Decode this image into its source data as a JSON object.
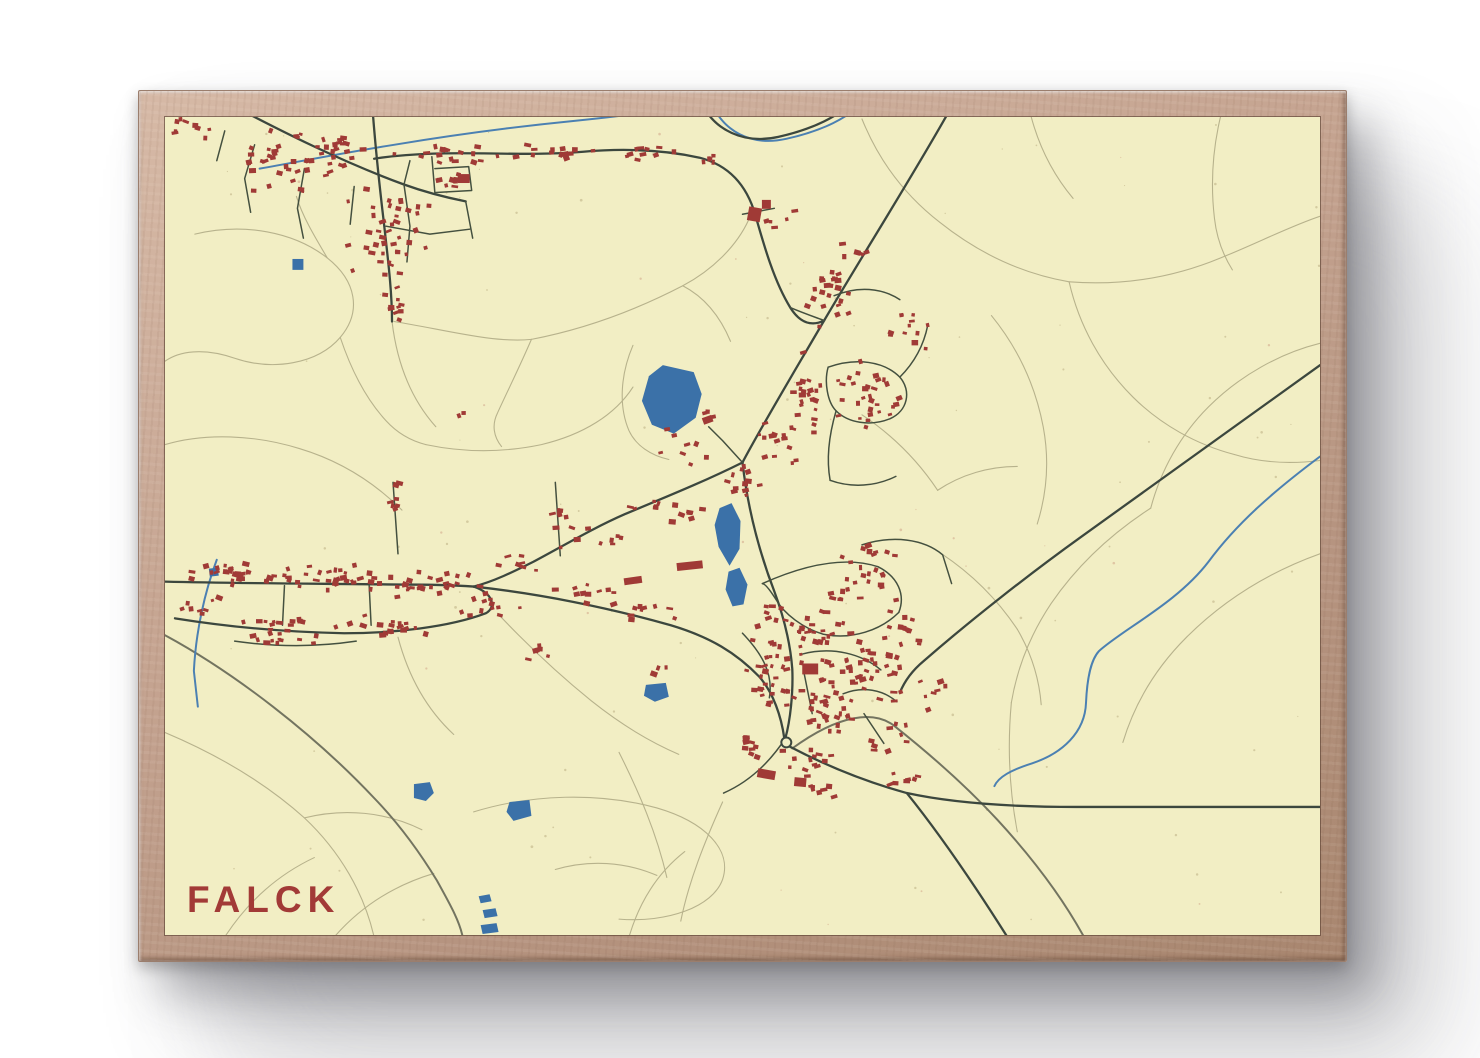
{
  "poster": {
    "title": "FALCK",
    "title_color": "#a23a37"
  },
  "frame": {
    "wood_light": "#d6b9a6",
    "wood_dark": "#a8866f"
  },
  "map": {
    "background": "#f2eec4",
    "seed": 20,
    "speckle_count": 120,
    "colors": {
      "building": "#a03a36",
      "water": "#3b71a8",
      "stream": "#4b80b2",
      "road_major": "#3c473e",
      "road_minor": "#44503f",
      "road_secondary": "#737460",
      "trail": "#b7b28c"
    },
    "roundabout": {
      "x": 624,
      "y": 630
    },
    "streams": [
      {
        "d": "M 95,52 C 140,44 180,36 230,28 C 290,18 350,10 410,4 C 450,0 505,-6 548,-16"
      },
      {
        "d": "M 548,-16 C 560,14 588,30 624,22 C 660,14 688,0 698,-14"
      },
      {
        "d": "M 52,446 C 40,478 31,518 29,558 L 33,594"
      },
      {
        "d": "M 1160,342 C 1112,378 1076,410 1048,448 C 1016,490 962,516 938,538 C 929,548 926,568 925,590 C 924,620 901,641 871,651 C 849,658 837,665 833,674"
      }
    ],
    "waters": [
      {
        "points": "500,250 531,257 539,279 533,303 511,319 489,310 479,286 486,261"
      },
      {
        "points": "557,394 569,389 578,407 577,435 567,452 556,433 552,411"
      },
      {
        "points": "566,458 577,454 585,471 581,491 570,493 563,476"
      },
      {
        "points": "250,672 266,670 270,681 262,689 250,686"
      },
      {
        "points": "346,690 366,688 368,704 350,709 343,700"
      },
      {
        "points": "483,572 503,570 506,584 492,589 481,583"
      },
      {
        "points": "128,143 139,143 139,154 128,154"
      },
      {
        "points": "315,785 326,783 328,790 317,792"
      },
      {
        "points": "319,799 332,797 334,805 321,807"
      },
      {
        "points": "317,814 333,812 335,821 319,823"
      },
      {
        "points": "44,455 53,454 54,462 45,463"
      }
    ],
    "roads_major": [
      {
        "d": "M 792,-14 C 758,48 700,140 662,205 C 630,260 600,310 580,348"
      },
      {
        "d": "M 580,348 C 585,392 596,436 612,478 C 622,505 628,530 630,556 C 631,580 628,608 623,626"
      },
      {
        "d": "M 580,348 C 540,368 500,384 462,400 C 430,414 400,432 370,448 C 350,458 330,468 310,473"
      },
      {
        "d": "M 0,468 C 80,470 160,470 240,471 C 268,471 295,472 310,473"
      },
      {
        "d": "M 310,473 C 375,480 445,494 508,512 C 548,524 574,540 597,564 C 611,580 619,604 622,626"
      },
      {
        "d": "M 10,505 C 60,513 120,519 180,520 C 230,520 285,514 322,500 C 333,494 330,480 310,473"
      },
      {
        "d": "M 627,634 C 665,654 705,670 745,681 C 795,692 855,695 915,695 L 1160,695"
      },
      {
        "d": "M 745,681 C 778,722 812,772 846,826"
      },
      {
        "d": "M 1160,250 C 1080,308 1000,366 920,423 C 870,459 810,506 762,548 C 750,558 742,570 738,580"
      },
      {
        "d": "M 67,-12 C 120,16 180,46 240,68 C 262,76 282,81 302,85"
      },
      {
        "d": "M 210,42 C 280,31 350,41 420,35 C 465,31 505,34 537,41 C 568,49 585,71 593,99 C 602,131 612,166 628,192 C 638,208 650,211 662,205"
      },
      {
        "d": "M 540,-12 C 552,12 580,28 616,20 C 652,12 678,-2 688,-14"
      },
      {
        "d": "M 208,-14 C 211,28 215,66 220,108 C 224,144 228,176 228,206"
      }
    ],
    "roads_minor": [
      {
        "d": "M 90,28 L 80,62 L 86,96"
      },
      {
        "d": "M 140,52 L 133,92 L 139,122"
      },
      {
        "d": "M 190,70 L 186,108"
      },
      {
        "d": "M 240,68 L 246,110 L 243,146"
      },
      {
        "d": "M 240,68 L 246,44"
      },
      {
        "d": "M 222,110 L 266,118 L 306,113"
      },
      {
        "d": "M 268,40 L 271,76"
      },
      {
        "d": "M 271,52 L 305,50 L 308,74 L 272,76"
      },
      {
        "d": "M 60,14 L 52,44"
      },
      {
        "d": "M 302,85 L 309,122"
      },
      {
        "d": "M 580,98 L 612,92"
      },
      {
        "d": "M 666,252 C 694,242 722,246 738,262 C 750,276 746,296 728,304 C 708,312 686,308 674,296 C 665,287 662,266 666,252"
      },
      {
        "d": "M 738,262 C 752,248 762,230 766,210"
      },
      {
        "d": "M 674,296 C 667,320 664,344 668,366"
      },
      {
        "d": "M 668,366 C 690,374 714,372 734,362"
      },
      {
        "d": "M 672,180 C 696,170 720,172 738,184"
      },
      {
        "d": "M 628,192 C 642,198 654,202 662,205"
      },
      {
        "d": "M 600,470 C 640,452 682,442 716,453"
      },
      {
        "d": "M 716,453 C 736,463 744,481 737,499"
      },
      {
        "d": "M 737,499 C 719,517 690,527 661,521"
      },
      {
        "d": "M 661,521 C 641,515 622,501 613,485 C 606,474 602,470 600,470"
      },
      {
        "d": "M 640,541 C 671,533 700,541 719,557"
      },
      {
        "d": "M 580,520 C 600,541 611,561 607,585"
      },
      {
        "d": "M 642,561 L 650,601"
      },
      {
        "d": "M 681,581 C 701,573 721,577 735,589"
      },
      {
        "d": "M 702,601 L 722,631"
      },
      {
        "d": "M 700,431 C 731,421 762,425 781,441 L 790,470"
      },
      {
        "d": "M 623,626 C 606,652 586,670 561,681"
      },
      {
        "d": "M 229,368 L 234,440"
      },
      {
        "d": "M 392,368 L 397,442"
      },
      {
        "d": "M 120,472 L 118,512"
      },
      {
        "d": "M 205,471 L 207,512"
      },
      {
        "d": "M 70,528 C 112,534 152,534 192,528"
      },
      {
        "d": "M 580,348 L 560,326 L 546,312"
      }
    ],
    "roads_secondary": [
      {
        "d": "M 0,522 C 70,560 150,622 210,686 C 236,713 256,741 273,769 C 288,796 296,811 299,826"
      },
      {
        "d": "M 630,636 C 678,601 712,598 732,613 C 766,640 801,670 836,708 C 871,746 901,786 923,826"
      }
    ],
    "trails": [
      {
        "d": "M 30,118 C 80,106 130,116 163,142 C 192,165 198,196 176,222 C 153,249 108,256 70,243 C 38,232 14,236 0,246"
      },
      {
        "d": "M 163,142 C 150,120 138,100 132,80"
      },
      {
        "d": "M 0,330 C 40,318 90,320 135,334 C 175,346 210,368 238,396"
      },
      {
        "d": "M 176,222 C 186,252 200,282 222,306 C 232,317 246,326 262,330"
      },
      {
        "d": "M 262,330 C 300,338 340,338 378,330 C 420,320 452,300 470,272"
      },
      {
        "d": "M 470,230 C 458,258 455,290 466,316 C 473,331 488,341 506,345"
      },
      {
        "d": "M 228,206 C 233,248 247,284 272,312"
      },
      {
        "d": "M 230,206 C 280,214 330,228 368,224"
      },
      {
        "d": "M 368,224 C 420,214 470,196 520,170 C 550,154 574,130 586,104"
      },
      {
        "d": "M 520,170 C 543,182 558,202 568,226"
      },
      {
        "d": "M 368,224 C 356,252 344,276 334,298 C 328,310 330,322 338,332"
      },
      {
        "d": "M 700,2 C 716,42 742,78 778,106 C 818,138 862,158 908,166"
      },
      {
        "d": "M 908,166 C 960,170 1012,162 1060,142 C 1095,128 1130,110 1160,100"
      },
      {
        "d": "M 908,166 C 918,210 940,250 972,282 C 1000,310 1036,330 1074,340"
      },
      {
        "d": "M 1160,228 C 1120,238 1080,260 1048,292 C 1020,320 1000,356 990,394"
      },
      {
        "d": "M 870,0 C 878,30 892,58 912,82"
      },
      {
        "d": "M 1060,0 C 1052,34 1050,68 1054,102 C 1056,120 1062,138 1072,154"
      },
      {
        "d": "M 830,200 C 856,232 874,270 882,312 C 888,344 886,378 876,410"
      },
      {
        "d": "M 990,394 C 950,420 916,452 890,490 C 870,520 856,554 850,590"
      },
      {
        "d": "M 1160,440 C 1110,458 1064,486 1026,524 C 996,554 974,590 962,630"
      },
      {
        "d": "M 850,590 C 846,634 848,678 856,720"
      },
      {
        "d": "M 1074,340 C 1100,348 1128,350 1160,346"
      },
      {
        "d": "M 0,620 C 52,642 100,670 140,706 C 176,740 200,782 210,826"
      },
      {
        "d": "M 140,706 C 180,696 222,700 258,718"
      },
      {
        "d": "M 60,826 C 82,792 112,764 150,746"
      },
      {
        "d": "M 170,826 C 196,796 230,774 270,762"
      },
      {
        "d": "M 466,826 C 476,792 494,762 522,740"
      },
      {
        "d": "M 310,700 C 368,682 436,680 494,696 C 542,710 570,738 560,768 C 550,796 504,812 456,808"
      },
      {
        "d": "M 456,640 C 476,680 494,722 504,766"
      },
      {
        "d": "M 560,690 C 542,730 526,770 518,810"
      },
      {
        "d": "M 334,500 C 364,532 396,562 428,588 C 458,612 488,630 516,642"
      },
      {
        "d": "M 234,524 C 244,562 262,596 290,622"
      },
      {
        "d": "M 392,758 C 426,748 462,750 494,764"
      },
      {
        "d": "M 700,300 C 730,320 756,346 776,376"
      },
      {
        "d": "M 776,376 C 800,360 828,352 856,352"
      },
      {
        "d": "M 780,440 C 810,460 836,486 856,516"
      },
      {
        "d": "M 856,516 C 870,540 878,566 880,592"
      }
    ],
    "building_clusters": [
      {
        "x": 30,
        "y": 10,
        "rx": 30,
        "ry": 14,
        "n": 10
      },
      {
        "x": 150,
        "y": 42,
        "rx": 95,
        "ry": 38,
        "n": 55
      },
      {
        "x": 225,
        "y": 120,
        "rx": 45,
        "ry": 55,
        "n": 40
      },
      {
        "x": 232,
        "y": 185,
        "rx": 18,
        "ry": 28,
        "n": 10
      },
      {
        "x": 300,
        "y": 38,
        "rx": 60,
        "ry": 12,
        "n": 18
      },
      {
        "x": 390,
        "y": 34,
        "rx": 50,
        "ry": 10,
        "n": 12
      },
      {
        "x": 470,
        "y": 36,
        "rx": 45,
        "ry": 10,
        "n": 10
      },
      {
        "x": 545,
        "y": 45,
        "rx": 20,
        "ry": 10,
        "n": 6
      },
      {
        "x": 288,
        "y": 62,
        "rx": 16,
        "ry": 12,
        "n": 8
      },
      {
        "x": 668,
        "y": 175,
        "rx": 30,
        "ry": 50,
        "n": 24
      },
      {
        "x": 705,
        "y": 280,
        "rx": 45,
        "ry": 42,
        "n": 30
      },
      {
        "x": 745,
        "y": 215,
        "rx": 28,
        "ry": 30,
        "n": 12
      },
      {
        "x": 640,
        "y": 280,
        "rx": 28,
        "ry": 45,
        "n": 22
      },
      {
        "x": 612,
        "y": 330,
        "rx": 26,
        "ry": 30,
        "n": 14
      },
      {
        "x": 585,
        "y": 368,
        "rx": 24,
        "ry": 22,
        "n": 12
      },
      {
        "x": 520,
        "y": 330,
        "rx": 28,
        "ry": 22,
        "n": 9
      },
      {
        "x": 500,
        "y": 395,
        "rx": 60,
        "ry": 16,
        "n": 13
      },
      {
        "x": 430,
        "y": 425,
        "rx": 45,
        "ry": 14,
        "n": 9
      },
      {
        "x": 360,
        "y": 450,
        "rx": 35,
        "ry": 12,
        "n": 7
      },
      {
        "x": 70,
        "y": 460,
        "rx": 65,
        "ry": 15,
        "n": 26
      },
      {
        "x": 170,
        "y": 464,
        "rx": 70,
        "ry": 16,
        "n": 30
      },
      {
        "x": 265,
        "y": 470,
        "rx": 60,
        "ry": 16,
        "n": 26
      },
      {
        "x": 130,
        "y": 510,
        "rx": 70,
        "ry": 12,
        "n": 18
      },
      {
        "x": 230,
        "y": 512,
        "rx": 55,
        "ry": 12,
        "n": 15
      },
      {
        "x": 120,
        "y": 526,
        "rx": 45,
        "ry": 7,
        "n": 10
      },
      {
        "x": 330,
        "y": 490,
        "rx": 40,
        "ry": 14,
        "n": 12
      },
      {
        "x": 40,
        "y": 494,
        "rx": 28,
        "ry": 10,
        "n": 8
      },
      {
        "x": 230,
        "y": 392,
        "rx": 16,
        "ry": 26,
        "n": 8
      },
      {
        "x": 394,
        "y": 402,
        "rx": 14,
        "ry": 24,
        "n": 6
      },
      {
        "x": 430,
        "y": 480,
        "rx": 45,
        "ry": 12,
        "n": 11
      },
      {
        "x": 495,
        "y": 498,
        "rx": 40,
        "ry": 12,
        "n": 9
      },
      {
        "x": 370,
        "y": 545,
        "rx": 28,
        "ry": 16,
        "n": 6
      },
      {
        "x": 640,
        "y": 520,
        "rx": 55,
        "ry": 42,
        "n": 46
      },
      {
        "x": 700,
        "y": 555,
        "rx": 48,
        "ry": 42,
        "n": 40
      },
      {
        "x": 660,
        "y": 600,
        "rx": 45,
        "ry": 32,
        "n": 30
      },
      {
        "x": 610,
        "y": 565,
        "rx": 33,
        "ry": 33,
        "n": 22
      },
      {
        "x": 700,
        "y": 470,
        "rx": 40,
        "ry": 24,
        "n": 18
      },
      {
        "x": 745,
        "y": 520,
        "rx": 24,
        "ry": 28,
        "n": 13
      },
      {
        "x": 700,
        "y": 438,
        "rx": 35,
        "ry": 13,
        "n": 10
      },
      {
        "x": 640,
        "y": 650,
        "rx": 38,
        "ry": 18,
        "n": 13
      },
      {
        "x": 585,
        "y": 635,
        "rx": 24,
        "ry": 16,
        "n": 9
      },
      {
        "x": 720,
        "y": 625,
        "rx": 28,
        "ry": 18,
        "n": 9
      },
      {
        "x": 770,
        "y": 575,
        "rx": 18,
        "ry": 24,
        "n": 7
      },
      {
        "x": 660,
        "y": 682,
        "rx": 28,
        "ry": 10,
        "n": 7
      },
      {
        "x": 740,
        "y": 668,
        "rx": 28,
        "ry": 12,
        "n": 7
      },
      {
        "x": 497,
        "y": 560,
        "rx": 10,
        "ry": 8,
        "n": 3
      },
      {
        "x": 300,
        "y": 300,
        "rx": 8,
        "ry": 6,
        "n": 2
      },
      {
        "x": 545,
        "y": 300,
        "rx": 12,
        "ry": 8,
        "n": 3
      },
      {
        "x": 620,
        "y": 105,
        "rx": 20,
        "ry": 14,
        "n": 5
      },
      {
        "x": 700,
        "y": 135,
        "rx": 14,
        "ry": 10,
        "n": 3
      }
    ],
    "large_buildings": [
      {
        "x": 527,
        "y": 452,
        "w": 26,
        "h": 8,
        "r": -6
      },
      {
        "x": 470,
        "y": 467,
        "w": 18,
        "h": 7,
        "r": -8
      },
      {
        "x": 592,
        "y": 98,
        "w": 13,
        "h": 14,
        "r": 10
      },
      {
        "x": 604,
        "y": 88,
        "w": 9,
        "h": 9,
        "r": 0
      },
      {
        "x": 648,
        "y": 556,
        "w": 16,
        "h": 11,
        "r": 0
      },
      {
        "x": 604,
        "y": 662,
        "w": 18,
        "h": 9,
        "r": 10
      },
      {
        "x": 638,
        "y": 670,
        "w": 12,
        "h": 9,
        "r": 5
      },
      {
        "x": 545,
        "y": 305,
        "w": 10,
        "h": 7,
        "r": -20
      },
      {
        "x": 300,
        "y": 62,
        "w": 12,
        "h": 9,
        "r": 0
      }
    ]
  }
}
